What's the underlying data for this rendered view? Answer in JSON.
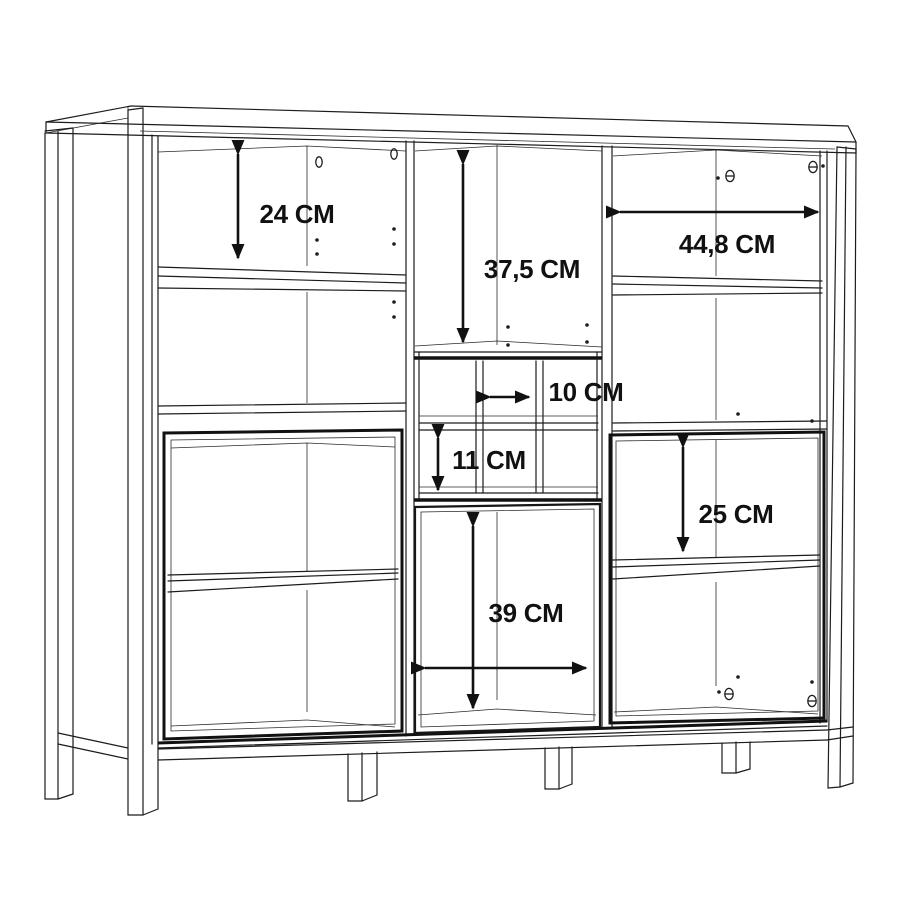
{
  "page": {
    "background": "#ffffff",
    "width": 900,
    "height": 900
  },
  "drawing": {
    "title": "Cabinet interior dimension drawing",
    "type": "furniture-assembly-dimension-diagram",
    "subject": "Highboard / display cabinet with open shelves, cubby compartments, glass doors and frame legs",
    "unit": "CM",
    "line_color": "#1c1c1c",
    "background_color": "#ffffff"
  },
  "dimensions": {
    "left_top_height": {
      "label": "24 CM",
      "value": 24,
      "unit": "CM",
      "orientation": "vertical",
      "location": "left column, top compartment height"
    },
    "middle_top_height": {
      "label": "37,5 CM",
      "value": 37.5,
      "unit": "CM",
      "orientation": "vertical",
      "location": "middle column, tall top compartment height"
    },
    "right_top_width": {
      "label": "44,8 CM",
      "value": 44.8,
      "unit": "CM",
      "orientation": "horizontal",
      "location": "right column, top compartment width"
    },
    "cubby_width": {
      "label": "10 CM",
      "value": 10,
      "unit": "CM",
      "orientation": "horizontal",
      "location": "middle cubby cell width"
    },
    "cubby_height": {
      "label": "11 CM",
      "value": 11,
      "unit": "CM",
      "orientation": "vertical",
      "location": "middle cubby cell height"
    },
    "right_middle_height": {
      "label": "25 CM",
      "value": 25,
      "unit": "CM",
      "orientation": "vertical",
      "location": "right door compartment height"
    },
    "middle_door_size": {
      "label": "39 CM",
      "value": 39,
      "unit": "CM",
      "orientation": "vertical+horizontal",
      "location": "middle lower door compartment width and height"
    }
  },
  "hardware_symbols": {
    "cam_lock": {
      "glyph": "θ",
      "meaning": "cam-lock fitting",
      "count": 4
    },
    "fitting_hole": {
      "glyph": "0",
      "meaning": "connector hole",
      "count": 2
    },
    "shelf_pin_hole": {
      "glyph": "•",
      "meaning": "shelf pin hole",
      "count": 14
    }
  }
}
